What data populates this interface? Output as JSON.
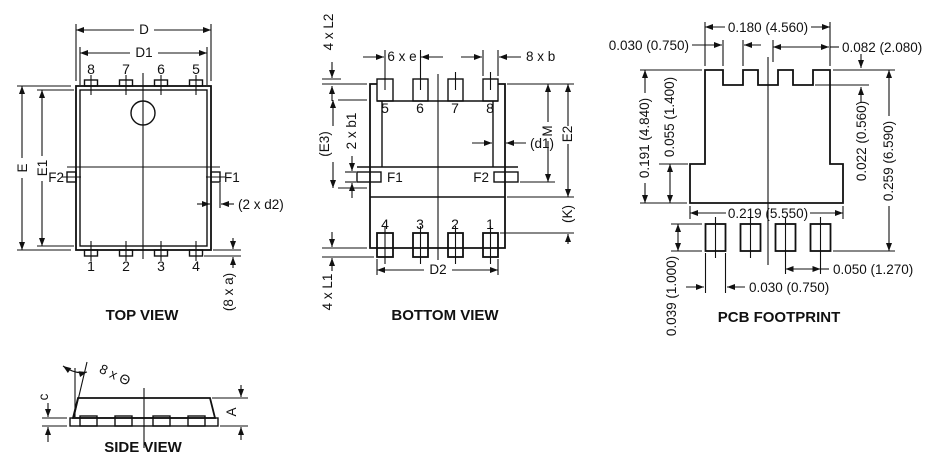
{
  "colors": {
    "ink": "#111111",
    "background": "#ffffff"
  },
  "top_view": {
    "title": "TOP VIEW",
    "dim_d": "D",
    "dim_d1": "D1",
    "dim_e": "E",
    "dim_e1": "E1",
    "label_f2": "F2",
    "label_f1": "F1",
    "dim_d2": "(2 x d2)",
    "dim_a": "(8 x a)",
    "pin_numbers_top": [
      "8",
      "7",
      "6",
      "5"
    ],
    "pin_numbers_bottom": [
      "1",
      "2",
      "3",
      "4"
    ]
  },
  "bottom_view": {
    "title": "BOTTOM VIEW",
    "dim_l2": "4 x L2",
    "dim_e_pitch": "6 x e",
    "dim_b": "8 x b",
    "dim_e3": "(E3)",
    "dim_b1": "2 x b1",
    "label_f1": "F1",
    "label_f2": "F2",
    "dim_d1": "(d1)",
    "dim_m": "M",
    "dim_e2": "E2",
    "dim_k": "(K)",
    "dim_l1": "4 x L1",
    "dim_d2": "D2",
    "pin_numbers_top": [
      "5",
      "6",
      "7",
      "8"
    ],
    "pin_numbers_bottom": [
      "4",
      "3",
      "2",
      "1"
    ]
  },
  "pcb_footprint": {
    "title": "PCB FOOTPRINT",
    "dim_pad_top_width": "0.180 (4.560)",
    "dim_notch_width": "0.030 (0.750)",
    "dim_right_offset": "0.082 (2.080)",
    "dim_pad_height": "0.191 (4.840)",
    "dim_tab_height": "0.055 (1.400)",
    "dim_notch_depth": "0.022 (0.560)",
    "dim_total_height": "0.259 (6.590)",
    "dim_tab_width": "0.219 (5.550)",
    "dim_lead_pad_height": "0.039 (1.000)",
    "dim_lead_pad_width": "0.030 (0.750)",
    "dim_lead_pitch": "0.050 (1.270)"
  },
  "side_view": {
    "title": "SIDE VIEW",
    "dim_angle": "8 x Θ",
    "dim_c": "c",
    "dim_a": "A"
  }
}
